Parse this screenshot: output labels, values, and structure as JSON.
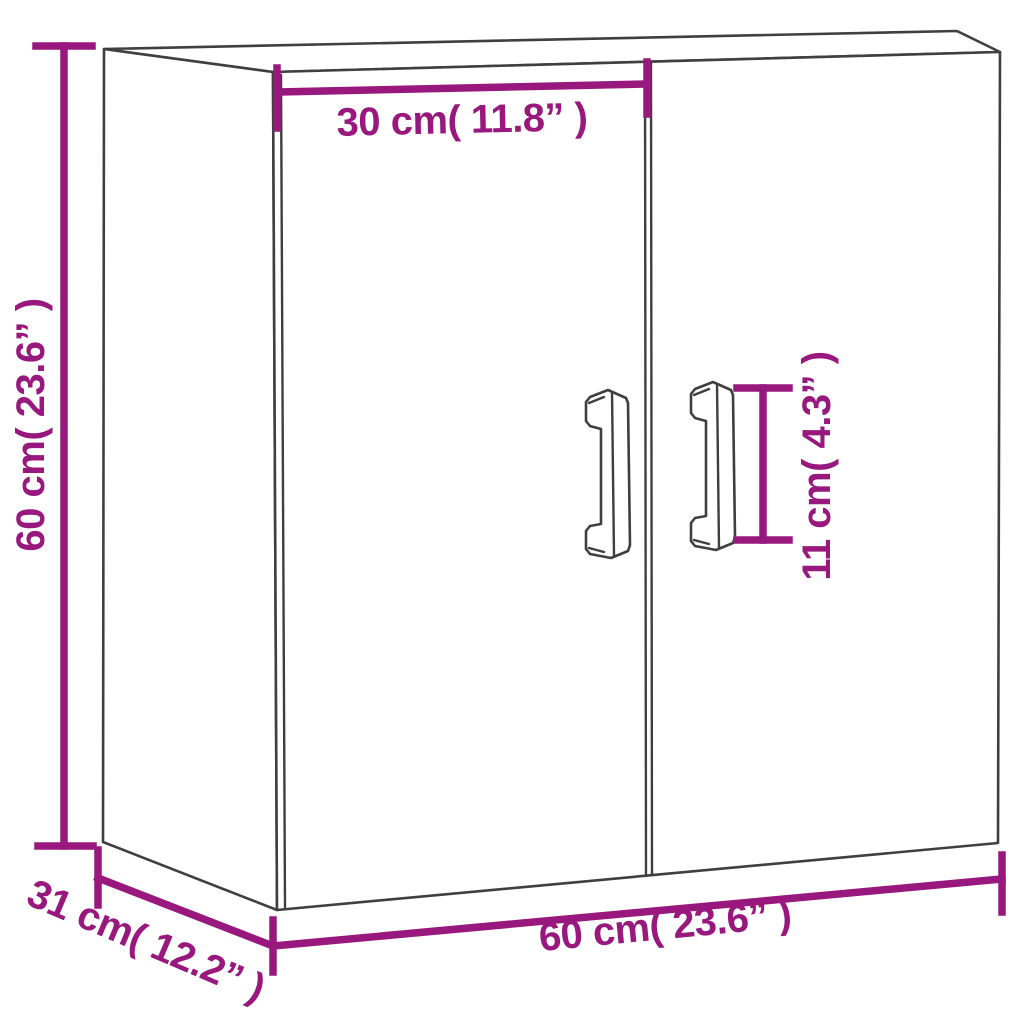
{
  "diagram": {
    "kind": "furniture-dimension-diagram",
    "subject": "two-door wall cabinet line drawing with dimension annotations",
    "colors": {
      "background": "#ffffff",
      "outline": "#3f3f3f",
      "dimension": "#98187e"
    },
    "dimensions": {
      "door_width": {
        "label": "30 cm( 11.8” )",
        "meaning": "width of one door (top annotation)"
      },
      "height": {
        "label": "60 cm( 23.6” )",
        "meaning": "cabinet height (left annotation)"
      },
      "handle_height": {
        "label": "11 cm( 4.3” )",
        "meaning": "handle length (right annotation)"
      },
      "total_width": {
        "label": "60 cm( 23.6” )",
        "meaning": "cabinet width (bottom annotation)"
      },
      "depth": {
        "label": "31 cm( 12.2” )",
        "meaning": "cabinet depth (bottom-left diagonal annotation)"
      }
    }
  }
}
